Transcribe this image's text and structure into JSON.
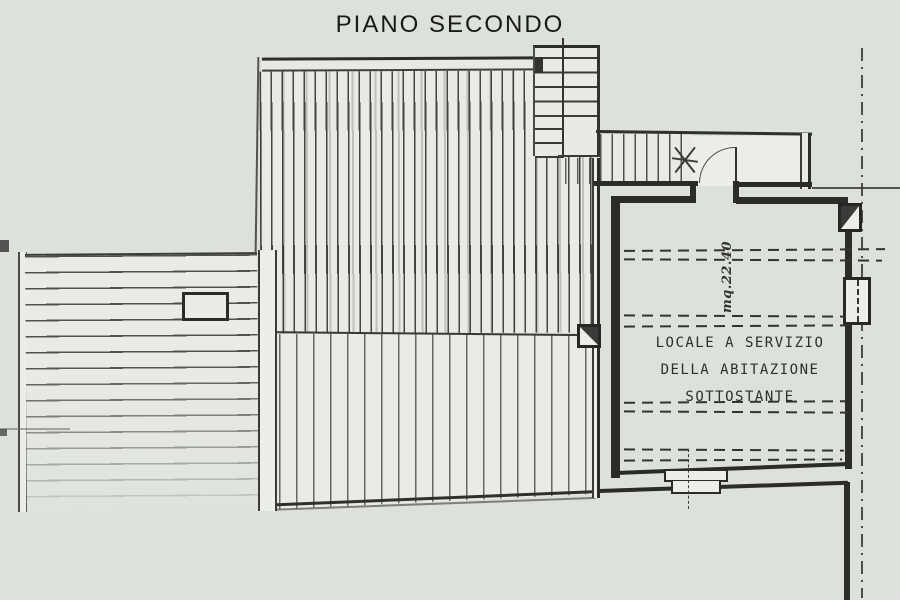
{
  "title": "PIANO SECONDO",
  "room": {
    "label_lines": [
      "LOCALE A SERVIZIO",
      "DELLA ABITAZIONE",
      "SOTTOSTANTE"
    ],
    "area": "mq.22.40"
  },
  "colors": {
    "background": "#dce1da",
    "paper": "#e9eae4",
    "ink": "#2b2b29"
  }
}
